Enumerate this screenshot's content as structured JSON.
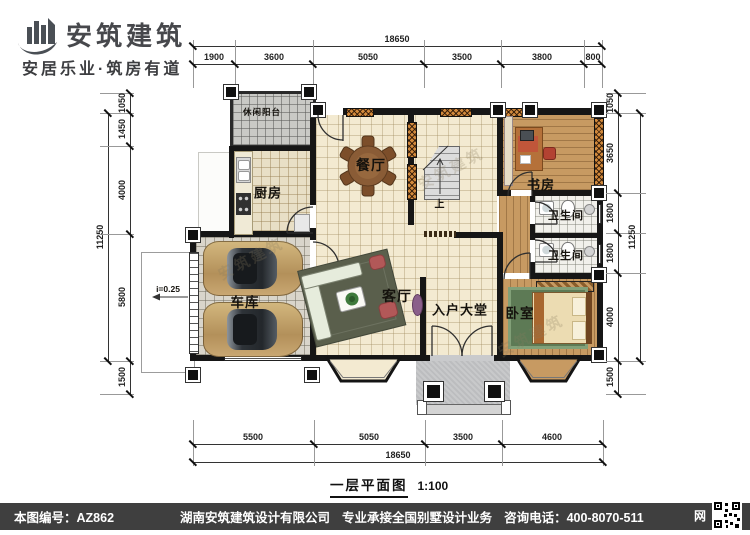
{
  "header": {
    "brand": "安筑建筑",
    "tagline": "安居乐业·筑房有道"
  },
  "rooms": {
    "balcony": "休闲阳台",
    "kitchen": "厨房",
    "dining": "餐厅",
    "study": "书房",
    "bath1": "卫生间",
    "bath2": "卫生间",
    "garage": "车库",
    "living": "客厅",
    "entry": "入户大堂",
    "bedroom": "卧室",
    "stairs_up": "上",
    "ramp_slope": "i=0.25"
  },
  "dims": {
    "top": {
      "total": "18650",
      "segments": [
        "1900",
        "3600",
        "5050",
        "3500",
        "3800",
        "800"
      ]
    },
    "bottom": {
      "total": "18650",
      "segments": [
        "5500",
        "5050",
        "3500",
        "4600"
      ]
    },
    "left": {
      "total": "11250",
      "segments": [
        "1050",
        "1450",
        "4000",
        "5800",
        "1500"
      ]
    },
    "right": {
      "total": "11250",
      "segments": [
        "1050",
        "3650",
        "1800",
        "1800",
        "4000",
        "1500"
      ]
    }
  },
  "title": {
    "name": "一层平面图",
    "scale": "1:100"
  },
  "footer": {
    "plan_no": "本图编号：AZ862",
    "company": "湖南安筑建筑设计有限公司",
    "service": "专业承接全国别墅设计业务",
    "phone": "咨询电话：400-8070-511",
    "net": "网"
  },
  "watermark": "安筑建筑",
  "colors": {
    "wall": "#161616",
    "wood": "#c79a62",
    "cream": "#f3ead1"
  }
}
